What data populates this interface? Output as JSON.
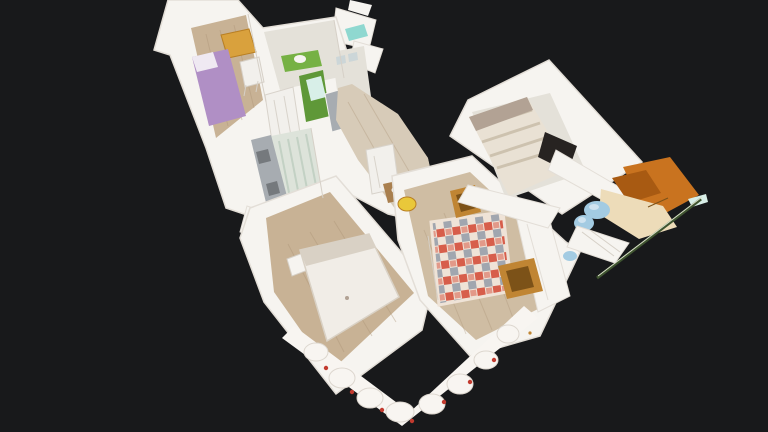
{
  "scene": {
    "description": "3D dollhouse cutaway view of an apartment floating on a dark background, seen from above at an angle",
    "view_mode": "dollhouse",
    "background": "#18191b"
  },
  "rooms": [
    {
      "id": "kid-bedroom",
      "label": "bedroom with purple single bed and orange dresser"
    },
    {
      "id": "bathroom",
      "label": "bathroom with green vanity wall"
    },
    {
      "id": "shower-room",
      "label": "shower room with grey shower"
    },
    {
      "id": "kitchen",
      "label": "kitchen with steel counter and shelf of bottles"
    },
    {
      "id": "hallway",
      "label": "hallway with light wood floor"
    },
    {
      "id": "master-bedroom",
      "label": "bedroom with white double bed"
    },
    {
      "id": "living-room",
      "label": "living room with patchwork sofa and gold table"
    },
    {
      "id": "bedroom-2",
      "label": "bedroom with striped bed and dark TV"
    },
    {
      "id": "balcony",
      "label": "terracotta balcony with blue blanket and railing"
    }
  ],
  "colors": {
    "bg": "#18191b",
    "wall": "#f6f4f0",
    "wallShade": "#e3ded7",
    "wallEdge": "#d6d0c7",
    "woodFloor": "#c8b295",
    "woodLight": "#d7cbb8",
    "woodLiving": "#cfbda3",
    "plank": "#ab9376",
    "paleFloor": "#e4e1d9",
    "kitchenFloor": "#dde3da",
    "kitchenStripe": "#c3d1c4",
    "steel": "#a7acb1",
    "steelDark": "#75797d",
    "green": "#76b144",
    "greenDark": "#5f9838",
    "mint": "#d8efe8",
    "teal": "#8fd8d0",
    "purple": "#b08fc5",
    "pillow": "#efe9f2",
    "dresser": "#d9a13d",
    "dresserDark": "#b97f23",
    "bedWhite": "#f1ede7",
    "bedShade": "#d9d1c5",
    "stripeA": "#e9e1d4",
    "stripeB": "#cdc2af",
    "headboard": "#b2a294",
    "tvDark": "#272321",
    "sofaBase": "#efe3d7",
    "sofaRed": "#d5503c",
    "sofaBlue": "#8d97a5",
    "gold": "#c08533",
    "goldDark": "#7c5218",
    "yellow": "#e9c83a",
    "balconyOrange": "#c9731f",
    "balconyDark": "#a85a12",
    "balconyBeige": "#eddcb9",
    "blueTextile": "#a3cbe2",
    "blueLight": "#cfe3f0",
    "railGreen": "#3f5430",
    "railLight": "#d9e0c8",
    "curtain": "#f8f5f1",
    "curtainShade": "#ddd7cf",
    "curtainRed": "#c23a2e",
    "shelfRed": "#cc3b2c",
    "shelfBlue": "#3a6db5",
    "shelfTan": "#caa05a",
    "doorWhite": "#f2f0ec",
    "doorLine": "#d8d3cb",
    "artGrey": "#ccd6d8",
    "tableWood": "#a97f4e"
  }
}
